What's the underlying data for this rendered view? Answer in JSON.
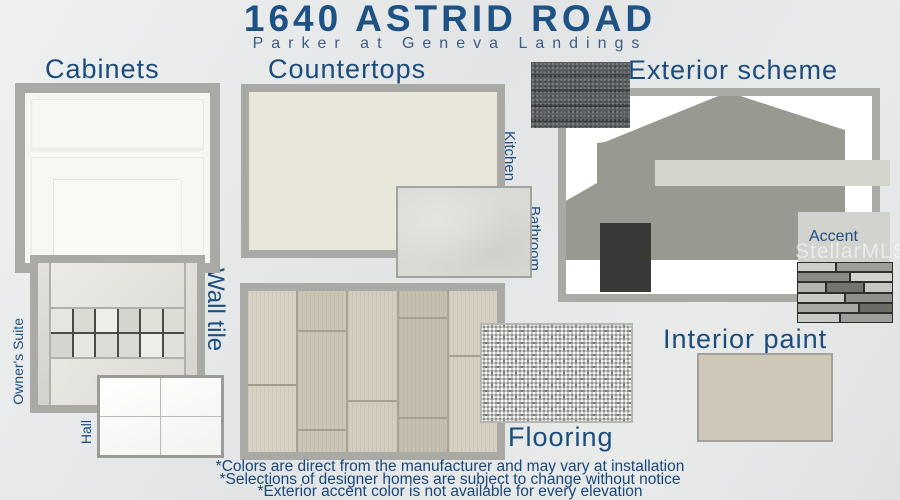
{
  "header": {
    "title": "1640 ASTRID ROAD",
    "subtitle": "Parker at Geneva Landings"
  },
  "sections": {
    "cabinets": {
      "label": "Cabinets"
    },
    "countertops": {
      "label": "Countertops",
      "kitchen": "Kitchen",
      "bathroom": "Bathroom"
    },
    "exterior": {
      "label": "Exterior scheme",
      "trim": "Trim",
      "front_door": "Front door",
      "accent": "Accent"
    },
    "wall_tile": {
      "label": "Wall tile",
      "owners_suite": "Owner's Suite",
      "hall": "Hall"
    },
    "flooring": {
      "label": "Flooring"
    },
    "interior_paint": {
      "label": "Interior paint"
    }
  },
  "watermark": "StellarMLS",
  "footnotes": [
    "*Colors are direct from the manufacturer and may vary at installation",
    "*Selections of designer homes are subject to change without notice",
    "*Exterior accent color is not available for every elevation"
  ],
  "colors": {
    "label_navy": "#1a4c7e",
    "title_blue": "#1e5285",
    "border_gray": "#a9aaa6",
    "house_body": "#989a92",
    "trim": "#d4d6ce",
    "front_door": "#3a3937",
    "accent": "#d2d2cf",
    "kitchen_countertop": "#e9e7da",
    "bathroom_countertop": "#d9d9d5",
    "interior_paint": "#cfc8b9"
  }
}
